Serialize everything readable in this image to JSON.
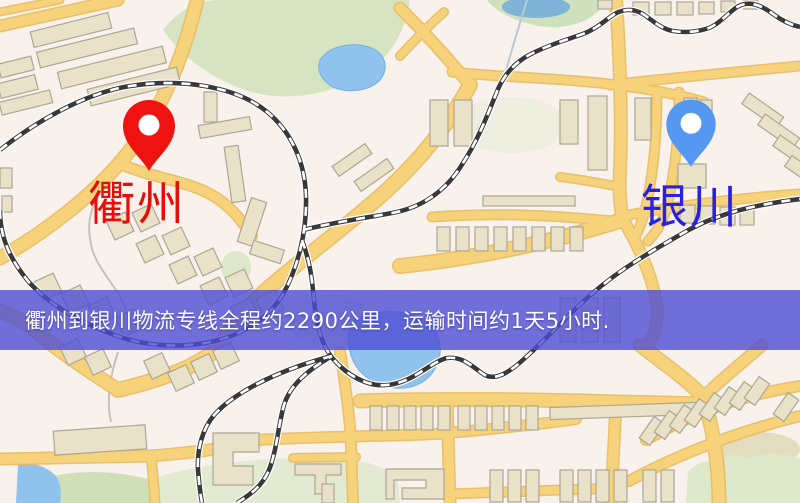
{
  "map": {
    "origin": {
      "label": "衢州",
      "pin_color": "#ee1310",
      "label_color": "#e60e0b"
    },
    "destination": {
      "label": "银川",
      "pin_color": "#5598f2",
      "label_color": "#2a21de"
    },
    "banner": {
      "text": "衢州到银川物流专线全程约2290公里，运输时间约1天5小时.",
      "distance_text": "约2290公里",
      "duration_text": "约1天5小时",
      "background_color": "#4d4dd4",
      "text_color": "#ffffff"
    },
    "palette": {
      "background": "#f8f1ec",
      "road_fill": "#f6d27a",
      "road_casing": "#e8ba5e",
      "building_fill": "#eae2c8",
      "building_outline": "#ada695",
      "park_green": "#d7e4c2",
      "water_blue": "#8fc2ec",
      "railway_dark": "#383838"
    }
  }
}
